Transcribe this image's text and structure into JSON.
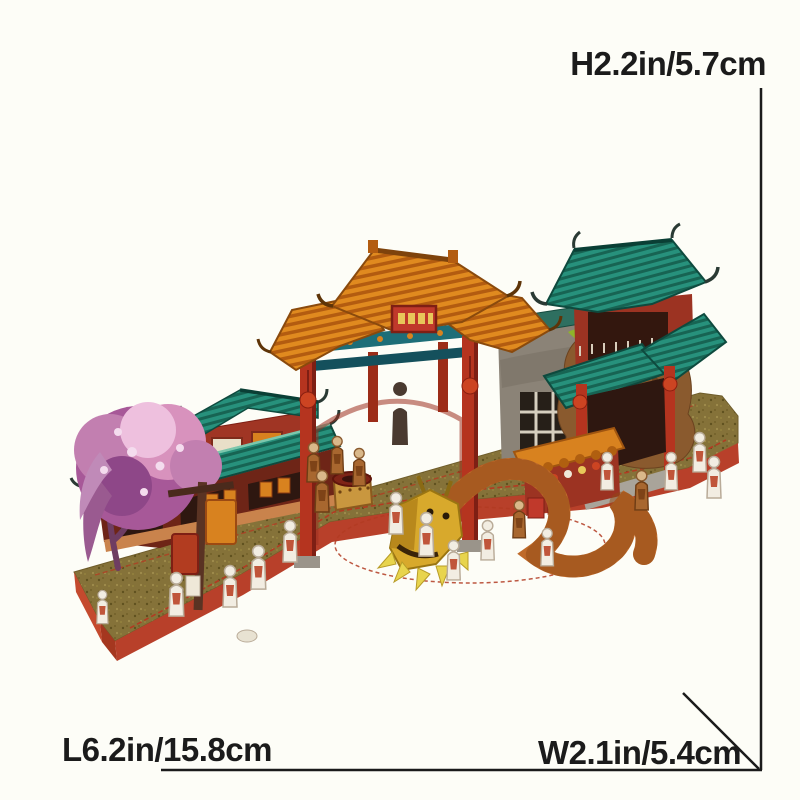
{
  "page": {
    "background": "#fdfdf7"
  },
  "photo": {
    "alt": "3D paper puzzle model of a Chinese festival street: memorial gate with orange roofs, teal-roofed shop and pavilion, pink blossom tree, stone wall, dragon dance and small paper figures on a long red-edged base"
  },
  "annotations": {
    "height": {
      "label": "H2.2in/5.7cm"
    },
    "length": {
      "label": "L6.2in/15.8cm"
    },
    "width": {
      "label": "W2.1in/5.4cm"
    }
  },
  "colors": {
    "ink": "#1b1b1b",
    "background": "#fdfdf7",
    "base_top": "#857239",
    "base_side": "#b8402a",
    "roof_teal": "#27917c",
    "roof_teal_dark": "#176453",
    "roof_orange": "#e08a1f",
    "roof_orange_dark": "#b35c10",
    "wall_red": "#a03524",
    "pillar_red": "#b5341f",
    "beam_teal": "#1d6e78",
    "stone_grey": "#8b8377",
    "blossom_pink": "#d892bd",
    "blossom_purple": "#a75898",
    "dragon_gold": "#d8a92c",
    "dragon_body": "#bf6a2a",
    "foliage_green": "#aac93a",
    "figure_white": "#f2ede2"
  }
}
